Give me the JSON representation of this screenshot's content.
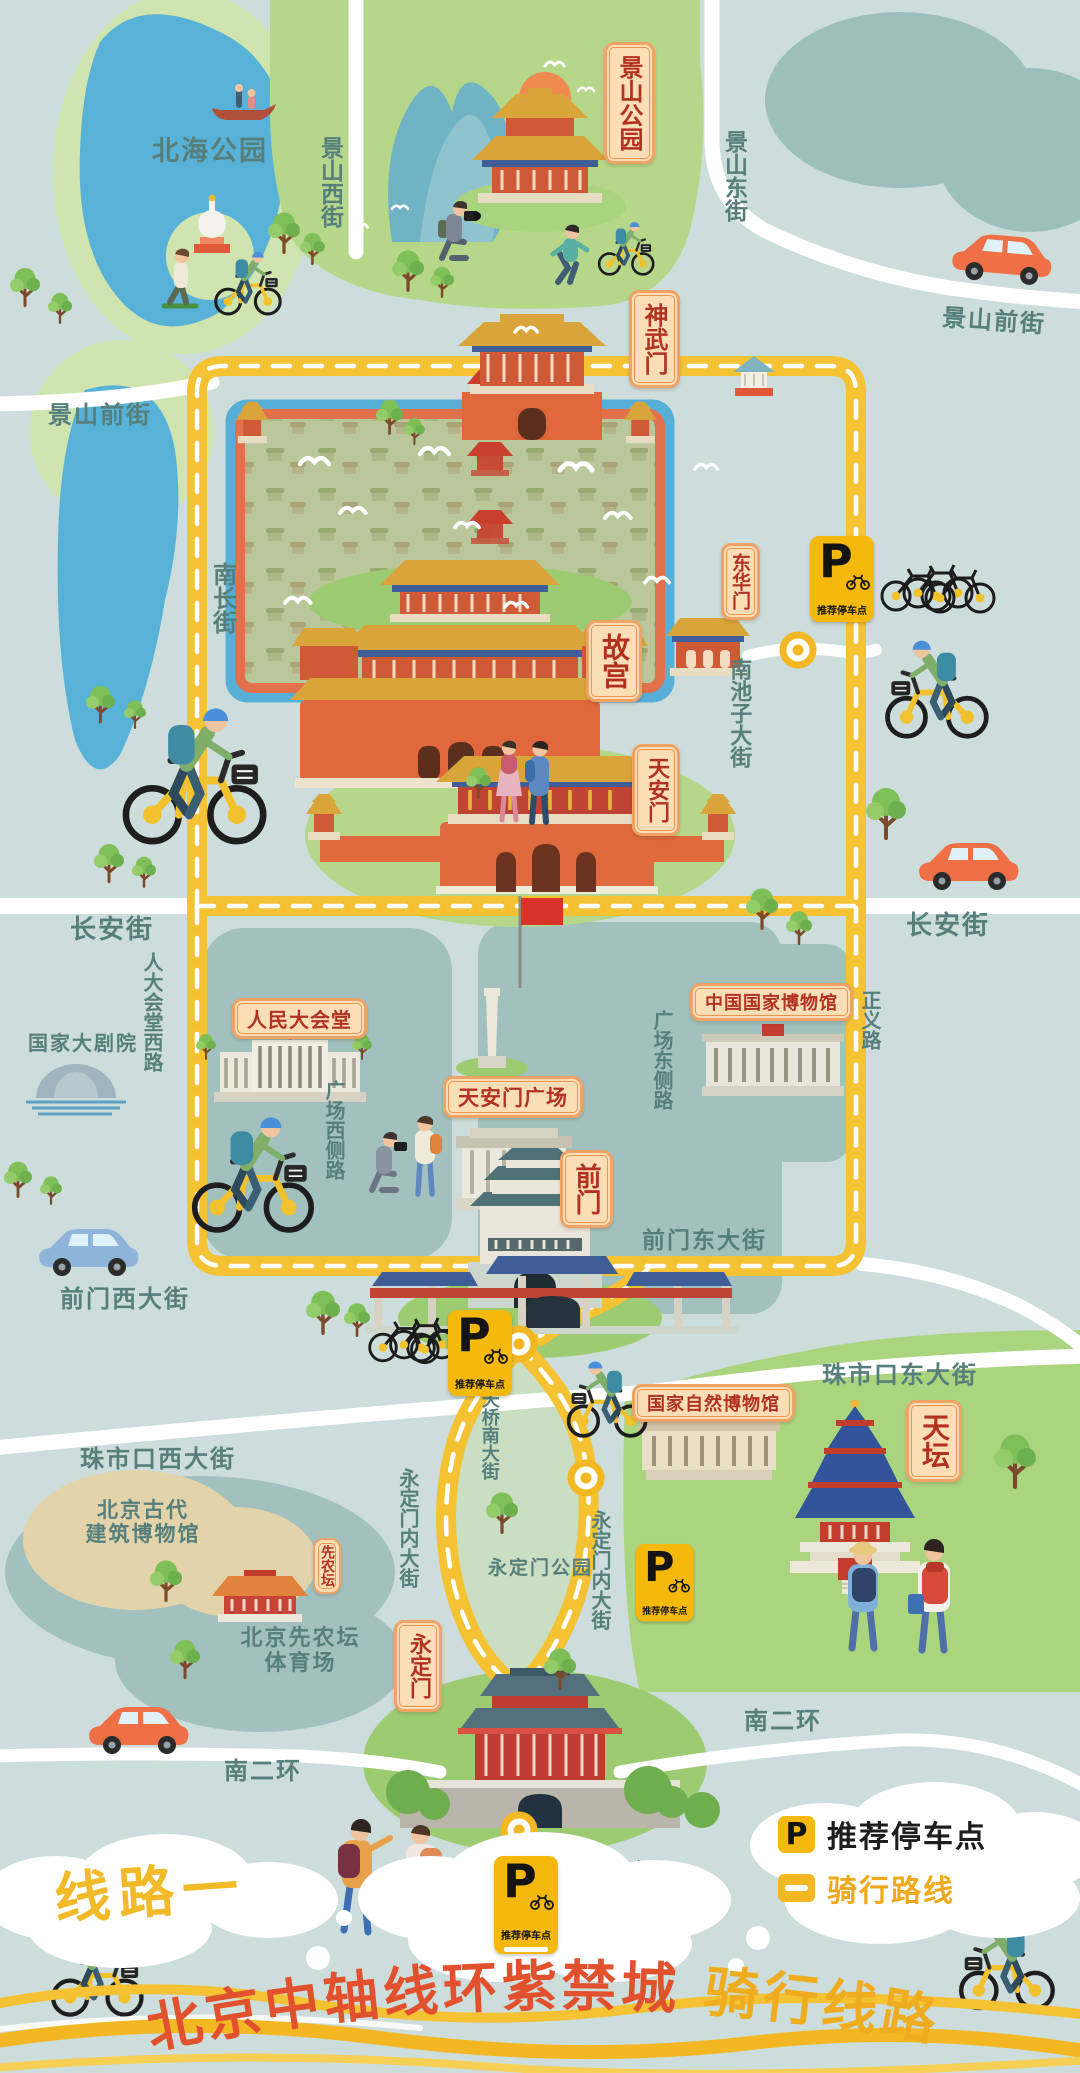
{
  "map_title": {
    "red": "北京中轴线环紫禁城",
    "yellow": "骑行线路",
    "route_tag": "线路一"
  },
  "legend": {
    "p": "P",
    "parking": "推荐停车点",
    "route": "骑行路线"
  },
  "parking_sign": {
    "p": "P",
    "caption": "推荐停车点"
  },
  "badges": {
    "jingshan_park": "景山公园",
    "shenwumen": "神武门",
    "donghuamen": "东华门",
    "gugong": "故宫",
    "tiananmen": "天安门",
    "qianmen": "前门",
    "tiantan": "天坛",
    "yongdingmen": "永定门",
    "xiannongtan": "先农坛",
    "great_hall": "人民大会堂",
    "tiananmen_square": "天安门广场",
    "national_museum": "中国国家博物馆",
    "natural_history_museum": "国家自然博物馆"
  },
  "streets": {
    "jingshan_xi": "景山西街",
    "jingshan_dong": "景山东街",
    "jingshan_qian_west": "景山前街",
    "jingshan_qian_east": "景山前街",
    "nanchang": "南长街",
    "nanchizi": "南池子大街",
    "changan_west": "长安街",
    "changan_east": "长安街",
    "rendahuitang_xi": "人大会堂西路",
    "guangchang_xice": "广场西侧路",
    "guangchang_dongce": "广场东侧路",
    "zhengyi": "正义路",
    "qianmen_xi": "前门西大街",
    "qianmen_dong": "前门东大街",
    "zhushikou_xi": "珠市口西大街",
    "zhushikou_dong": "珠市口东大街",
    "tianqiao_nan": "天桥南大街",
    "yongdingmennei_west": "永定门内大街",
    "yongdingmennei_east": "永定门内大街",
    "nanerhuan_west": "南二环",
    "nanerhuan_east": "南二环"
  },
  "places": {
    "beihai_park": "北海公园",
    "ncpa": "国家大剧院",
    "ancient_museum_line1": "北京古代",
    "ancient_museum_line2": "建筑博物馆",
    "stadium_line1": "北京先农坛",
    "stadium_line2": "体育场",
    "yongdingmen_park": "永定门公园"
  },
  "colors": {
    "background": "#ccdddb",
    "route_yellow": "#f4c233",
    "parking_yellow": "#f5b80d",
    "badge_cream": "#fcdeb6",
    "badge_border": "#f0a366",
    "badge_text_red": "#b23222",
    "street_text": "#567f7c",
    "title_red": "#e2512d",
    "title_yellow": "#efac1e",
    "lake_blue": "#58b2d8",
    "park_green": "#b6d78a"
  }
}
